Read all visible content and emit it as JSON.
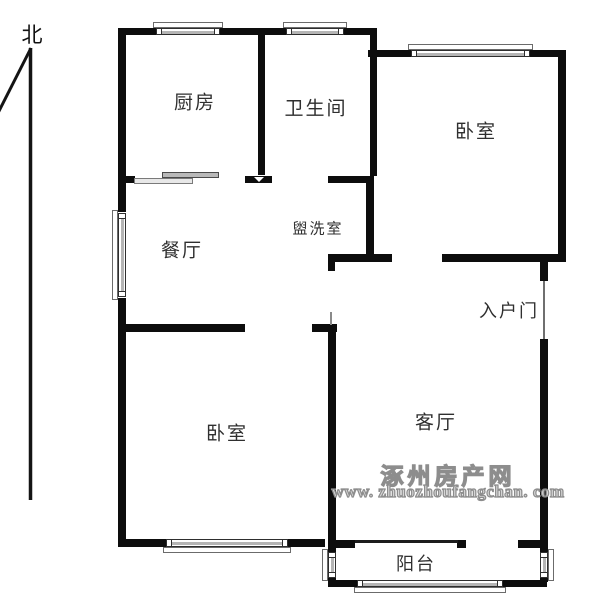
{
  "meta": {
    "background_color": "#ffffff",
    "wall_color": "#0d0d0d",
    "label_color": "#2f2f2f",
    "window_gray": "#b5b5b5",
    "watermark_fill": "#d6d6d6",
    "watermark_outline": "#8d8d8d"
  },
  "compass": {
    "label": "北",
    "x": 32,
    "y": 34
  },
  "rooms": [
    {
      "id": "kitchen",
      "label": "厨房",
      "x": 195,
      "y": 101,
      "fs": 19
    },
    {
      "id": "bathroom",
      "label": "卫生间",
      "x": 316,
      "y": 107,
      "fs": 19
    },
    {
      "id": "bedroom-ne",
      "label": "卧室",
      "x": 476,
      "y": 130,
      "fs": 19
    },
    {
      "id": "dining",
      "label": "餐厅",
      "x": 182,
      "y": 249,
      "fs": 19
    },
    {
      "id": "washroom",
      "label": "盥洗室",
      "x": 318,
      "y": 228,
      "fs": 15
    },
    {
      "id": "entry-door",
      "label": "入户门",
      "x": 509,
      "y": 310,
      "fs": 18
    },
    {
      "id": "bedroom-sw",
      "label": "卧室",
      "x": 227,
      "y": 432,
      "fs": 19
    },
    {
      "id": "living",
      "label": "客厅",
      "x": 436,
      "y": 421,
      "fs": 19
    },
    {
      "id": "balcony",
      "label": "阳台",
      "x": 416,
      "y": 563,
      "fs": 18
    }
  ],
  "watermark": {
    "line1": "涿州房产网",
    "line2": "www. zhuozhoufangchan. com"
  },
  "plan": {
    "walls": [
      {
        "x": 118,
        "y": 28,
        "w": 259,
        "h": 7
      },
      {
        "x": 118,
        "y": 35,
        "w": 8,
        "h": 177
      },
      {
        "x": 118,
        "y": 298,
        "w": 8,
        "h": 249
      },
      {
        "x": 370,
        "y": 35,
        "w": 7,
        "h": 141
      },
      {
        "x": 368,
        "y": 50,
        "w": 198,
        "h": 7
      },
      {
        "x": 558,
        "y": 57,
        "w": 8,
        "h": 203
      },
      {
        "x": 442,
        "y": 254,
        "w": 124,
        "h": 8
      },
      {
        "x": 328,
        "y": 254,
        "w": 64,
        "h": 8
      },
      {
        "x": 328,
        "y": 262,
        "w": 7,
        "h": 9
      },
      {
        "x": 540,
        "y": 262,
        "w": 8,
        "h": 19
      },
      {
        "x": 540,
        "y": 339,
        "w": 8,
        "h": 243
      },
      {
        "x": 258,
        "y": 34,
        "w": 7,
        "h": 141
      },
      {
        "x": 118,
        "y": 176,
        "w": 17,
        "h": 7
      },
      {
        "x": 245,
        "y": 176,
        "w": 27,
        "h": 7
      },
      {
        "x": 328,
        "y": 176,
        "w": 44,
        "h": 7
      },
      {
        "x": 366,
        "y": 176,
        "w": 8,
        "h": 82
      },
      {
        "x": 118,
        "y": 324,
        "w": 127,
        "h": 8
      },
      {
        "x": 312,
        "y": 324,
        "w": 25,
        "h": 8
      },
      {
        "x": 328,
        "y": 324,
        "w": 8,
        "h": 258
      },
      {
        "x": 118,
        "y": 539,
        "w": 207,
        "h": 8
      },
      {
        "x": 328,
        "y": 540,
        "w": 27,
        "h": 8
      },
      {
        "x": 457,
        "y": 540,
        "w": 9,
        "h": 8
      },
      {
        "x": 518,
        "y": 540,
        "w": 30,
        "h": 8
      },
      {
        "x": 328,
        "y": 580,
        "w": 219,
        "h": 7
      }
    ],
    "windows": [
      {
        "id": "kitchen-window",
        "o": "h",
        "x": 157,
        "wy": 28,
        "w": 62,
        "t": 7,
        "out": "top"
      },
      {
        "id": "bathroom-window",
        "o": "h",
        "x": 287,
        "wy": 28,
        "w": 56,
        "t": 7,
        "out": "top"
      },
      {
        "id": "bedroom-ne-window",
        "o": "h",
        "x": 412,
        "wy": 50,
        "w": 117,
        "t": 7,
        "out": "top"
      },
      {
        "id": "bedroom-sw-window",
        "o": "h",
        "x": 167,
        "wy": 539,
        "w": 120,
        "t": 8,
        "out": "bottom"
      },
      {
        "id": "balcony-window",
        "o": "h",
        "x": 358,
        "wy": 580,
        "w": 144,
        "t": 7,
        "out": "bottom"
      },
      {
        "id": "dining-window",
        "o": "v",
        "wx": 118,
        "y": 214,
        "h": 82,
        "t": 8,
        "out": "left"
      },
      {
        "id": "balcony-window-left",
        "o": "v",
        "wx": 328,
        "y": 553,
        "h": 24,
        "t": 8,
        "out": "left"
      },
      {
        "id": "balcony-window-right",
        "o": "v",
        "wx": 540,
        "y": 553,
        "h": 24,
        "t": 8,
        "out": "right"
      }
    ],
    "door_lines": [
      {
        "id": "entry-door-leaf",
        "x": 543,
        "y": 281,
        "w": 2,
        "h": 58,
        "c": "#6f6f6f"
      },
      {
        "id": "balcony-door-slider",
        "x": 355,
        "y": 540,
        "w": 103,
        "h": 3,
        "c": "#1c1c1c"
      },
      {
        "id": "hall-door-tick",
        "x": 330,
        "y": 312,
        "w": 2,
        "h": 13,
        "c": "#8a8a8a"
      }
    ],
    "slider_panels": [
      {
        "id": "kitchen-slider-upper",
        "x": 162,
        "y": 172,
        "w": 57,
        "h": 6,
        "lite": false
      },
      {
        "id": "kitchen-slider-lower",
        "x": 134,
        "y": 178,
        "w": 59,
        "h": 6,
        "lite": true
      }
    ],
    "door_arrow": {
      "x": 254,
      "y": 177
    }
  }
}
